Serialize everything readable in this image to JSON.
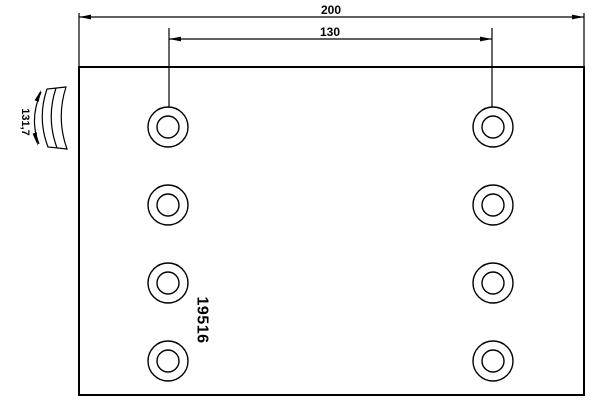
{
  "drawing": {
    "title": "brake lining technical drawing",
    "background_color": "#ffffff",
    "line_color": "#000000",
    "part_number": "19516",
    "dimensions": {
      "overall_width": {
        "label": "200"
      },
      "hole_spacing": {
        "label": "130"
      },
      "arc_length": {
        "label": "131,7"
      }
    },
    "holes": {
      "columns_x": [
        168,
        493
      ],
      "rows_y": [
        127,
        205,
        283,
        361
      ],
      "outer_radius": 20,
      "inner_radius": 11
    }
  }
}
